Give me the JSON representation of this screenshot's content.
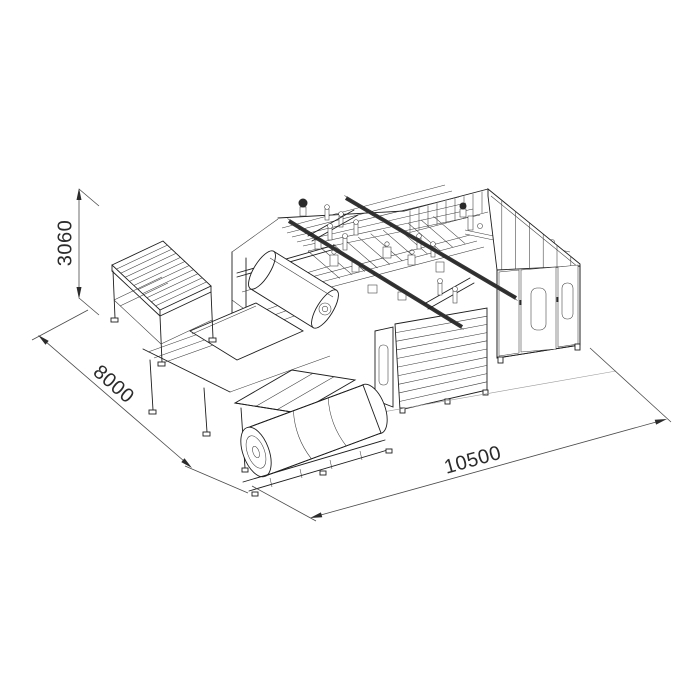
{
  "page": {
    "background_color": "#ffffff",
    "line_color": "#1e1e1e",
    "text_color": "#2b2b2b"
  },
  "drawing": {
    "kind": "isometric technical line drawing of an industrial machine line",
    "dimensions": {
      "height": "3060",
      "depth": "8000",
      "length": "10500"
    },
    "components": [
      "infeed-roller-table",
      "process-deck",
      "gantry-rails",
      "film-roll",
      "panel-sheet",
      "louvered-front-wall",
      "electrical-enclosure",
      "enclosure-doors",
      "outfeed-conveyor",
      "rolling-drum"
    ]
  }
}
